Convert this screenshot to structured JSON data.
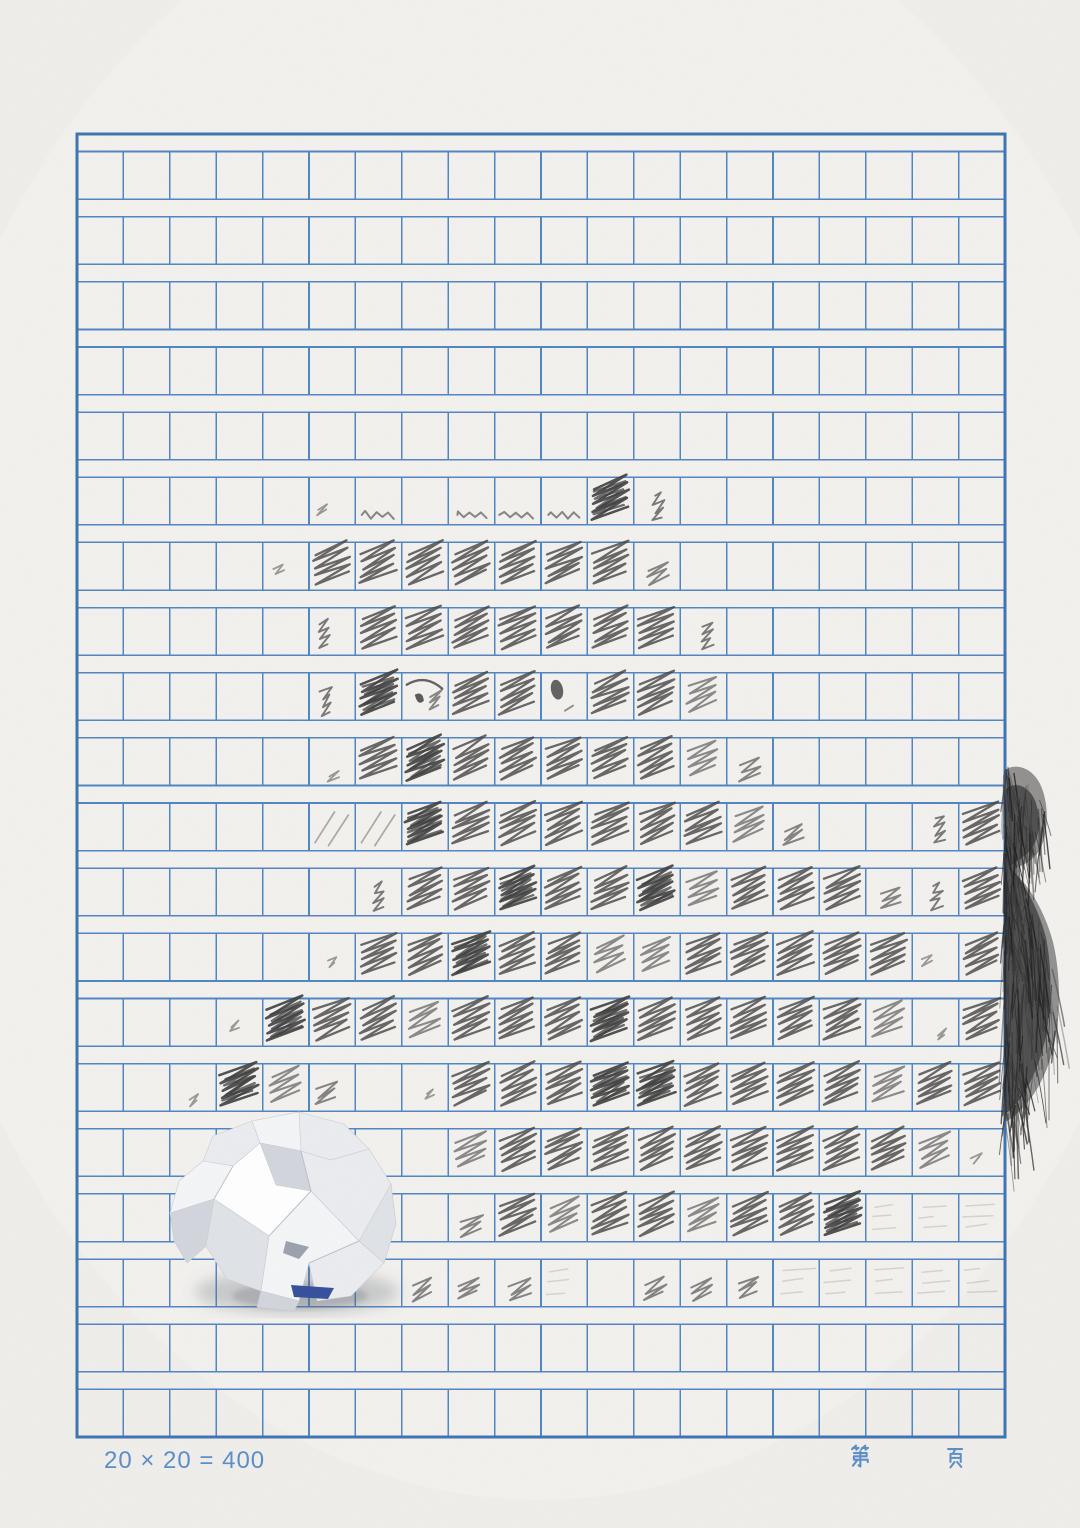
{
  "page": {
    "kind": "chinese-composition-manuscript-paper",
    "content_note": "blank squared writing grid, most cells scribbled out in pencil, crumpled paper ball on sheet, tuft of hair at right edge"
  },
  "grid": {
    "rows": 20,
    "cols": 20,
    "total_cells": 400
  },
  "footer": {
    "formula": "20 × 20 = 400",
    "page_prefix": "第",
    "page_suffix": "页"
  },
  "colors": {
    "paper": "#f1f0ed",
    "paper_edge": "#eceae6",
    "grid_line": "#4f85c2",
    "grid_border": "#3e73af",
    "pencil": "#3d3d3d",
    "pencil_faint": "#6a6a6a",
    "hair": "#242424",
    "footer_text": "#5d8ec7",
    "ball": [
      "#ffffff",
      "#f4f5f7",
      "#eaecef",
      "#dfe2e7",
      "#d2d6dc",
      "#c2c6ce"
    ],
    "ball_blue": "#34509b",
    "ball_crevice": "#9aa1ad",
    "ball_shadow": "rgba(104,108,122,0.30)"
  },
  "objects": {
    "paper_ball": {
      "type": "crumpled-paper-ball"
    },
    "hair_tuft": {
      "type": "pencil-drawn-hair-tuft"
    }
  },
  "scribbles": {
    "marks": [
      [
        6,
        6,
        "tiny"
      ],
      [
        6,
        7,
        "wave"
      ],
      [
        6,
        9,
        "wave"
      ],
      [
        6,
        10,
        "wave"
      ],
      [
        6,
        11,
        "wave"
      ],
      [
        6,
        12,
        "heavy"
      ],
      [
        6,
        13,
        "vsmall"
      ],
      [
        7,
        5,
        "tiny"
      ],
      [
        7,
        6,
        "full"
      ],
      [
        7,
        7,
        "full"
      ],
      [
        7,
        8,
        "full"
      ],
      [
        7,
        9,
        "full"
      ],
      [
        7,
        10,
        "full"
      ],
      [
        7,
        11,
        "full"
      ],
      [
        7,
        12,
        "full"
      ],
      [
        7,
        13,
        "small"
      ],
      [
        8,
        6,
        "vsmall"
      ],
      [
        8,
        7,
        "full"
      ],
      [
        8,
        8,
        "full"
      ],
      [
        8,
        9,
        "full"
      ],
      [
        8,
        10,
        "full"
      ],
      [
        8,
        11,
        "full"
      ],
      [
        8,
        12,
        "full"
      ],
      [
        8,
        13,
        "full"
      ],
      [
        8,
        14,
        "vsmall"
      ],
      [
        9,
        6,
        "vsmall"
      ],
      [
        9,
        7,
        "heavy"
      ],
      [
        9,
        8,
        "eyeL"
      ],
      [
        9,
        9,
        "full"
      ],
      [
        9,
        10,
        "full"
      ],
      [
        9,
        11,
        "eyeR"
      ],
      [
        9,
        12,
        "full"
      ],
      [
        9,
        13,
        "full"
      ],
      [
        9,
        14,
        "medium"
      ],
      [
        10,
        6,
        "tiny"
      ],
      [
        10,
        7,
        "full"
      ],
      [
        10,
        8,
        "heavy"
      ],
      [
        10,
        9,
        "full"
      ],
      [
        10,
        10,
        "full"
      ],
      [
        10,
        11,
        "full"
      ],
      [
        10,
        12,
        "full"
      ],
      [
        10,
        13,
        "full"
      ],
      [
        10,
        14,
        "medium"
      ],
      [
        10,
        15,
        "small"
      ],
      [
        11,
        6,
        "lines"
      ],
      [
        11,
        7,
        "lines"
      ],
      [
        11,
        8,
        "heavy"
      ],
      [
        11,
        9,
        "full"
      ],
      [
        11,
        10,
        "full"
      ],
      [
        11,
        11,
        "full"
      ],
      [
        11,
        12,
        "full"
      ],
      [
        11,
        13,
        "full"
      ],
      [
        11,
        14,
        "full"
      ],
      [
        11,
        15,
        "medium"
      ],
      [
        11,
        16,
        "small"
      ],
      [
        11,
        19,
        "vsmall"
      ],
      [
        11,
        20,
        "full"
      ],
      [
        12,
        7,
        "vsmall"
      ],
      [
        12,
        8,
        "full"
      ],
      [
        12,
        9,
        "full"
      ],
      [
        12,
        10,
        "heavy"
      ],
      [
        12,
        11,
        "full"
      ],
      [
        12,
        12,
        "full"
      ],
      [
        12,
        13,
        "heavy"
      ],
      [
        12,
        14,
        "medium"
      ],
      [
        12,
        15,
        "full"
      ],
      [
        12,
        16,
        "full"
      ],
      [
        12,
        17,
        "full"
      ],
      [
        12,
        18,
        "small"
      ],
      [
        12,
        19,
        "vsmall"
      ],
      [
        12,
        20,
        "full"
      ],
      [
        13,
        6,
        "tiny"
      ],
      [
        13,
        7,
        "full"
      ],
      [
        13,
        8,
        "full"
      ],
      [
        13,
        9,
        "heavy"
      ],
      [
        13,
        10,
        "full"
      ],
      [
        13,
        11,
        "full"
      ],
      [
        13,
        12,
        "medium"
      ],
      [
        13,
        13,
        "medium"
      ],
      [
        13,
        14,
        "full"
      ],
      [
        13,
        15,
        "full"
      ],
      [
        13,
        16,
        "full"
      ],
      [
        13,
        17,
        "full"
      ],
      [
        13,
        18,
        "full"
      ],
      [
        13,
        19,
        "tiny"
      ],
      [
        13,
        20,
        "full"
      ],
      [
        14,
        4,
        "tiny"
      ],
      [
        14,
        5,
        "heavy"
      ],
      [
        14,
        6,
        "full"
      ],
      [
        14,
        7,
        "full"
      ],
      [
        14,
        8,
        "medium"
      ],
      [
        14,
        9,
        "full"
      ],
      [
        14,
        10,
        "full"
      ],
      [
        14,
        11,
        "full"
      ],
      [
        14,
        12,
        "heavy"
      ],
      [
        14,
        13,
        "full"
      ],
      [
        14,
        14,
        "full"
      ],
      [
        14,
        15,
        "full"
      ],
      [
        14,
        16,
        "full"
      ],
      [
        14,
        17,
        "full"
      ],
      [
        14,
        18,
        "medium"
      ],
      [
        14,
        19,
        "tiny"
      ],
      [
        14,
        20,
        "full"
      ],
      [
        15,
        3,
        "tiny"
      ],
      [
        15,
        4,
        "heavy"
      ],
      [
        15,
        5,
        "medium"
      ],
      [
        15,
        6,
        "small"
      ],
      [
        15,
        8,
        "tiny"
      ],
      [
        15,
        9,
        "full"
      ],
      [
        15,
        10,
        "full"
      ],
      [
        15,
        11,
        "full"
      ],
      [
        15,
        12,
        "heavy"
      ],
      [
        15,
        13,
        "heavy"
      ],
      [
        15,
        14,
        "full"
      ],
      [
        15,
        15,
        "full"
      ],
      [
        15,
        16,
        "full"
      ],
      [
        15,
        17,
        "full"
      ],
      [
        15,
        18,
        "medium"
      ],
      [
        15,
        19,
        "full"
      ],
      [
        15,
        20,
        "full"
      ],
      [
        16,
        9,
        "medium"
      ],
      [
        16,
        10,
        "full"
      ],
      [
        16,
        11,
        "full"
      ],
      [
        16,
        12,
        "full"
      ],
      [
        16,
        13,
        "full"
      ],
      [
        16,
        14,
        "full"
      ],
      [
        16,
        15,
        "full"
      ],
      [
        16,
        16,
        "full"
      ],
      [
        16,
        17,
        "full"
      ],
      [
        16,
        18,
        "full"
      ],
      [
        16,
        19,
        "medium"
      ],
      [
        16,
        20,
        "tiny"
      ],
      [
        17,
        9,
        "small"
      ],
      [
        17,
        10,
        "full"
      ],
      [
        17,
        11,
        "medium"
      ],
      [
        17,
        12,
        "full"
      ],
      [
        17,
        13,
        "full"
      ],
      [
        17,
        14,
        "medium"
      ],
      [
        17,
        15,
        "full"
      ],
      [
        17,
        16,
        "full"
      ],
      [
        17,
        17,
        "heavy"
      ],
      [
        17,
        18,
        "faint"
      ],
      [
        17,
        19,
        "faint"
      ],
      [
        17,
        20,
        "faint"
      ],
      [
        18,
        8,
        "small"
      ],
      [
        18,
        9,
        "small"
      ],
      [
        18,
        10,
        "small"
      ],
      [
        18,
        11,
        "faint"
      ],
      [
        18,
        13,
        "small"
      ],
      [
        18,
        14,
        "small"
      ],
      [
        18,
        15,
        "small"
      ],
      [
        18,
        16,
        "faint"
      ],
      [
        18,
        17,
        "faint"
      ],
      [
        18,
        18,
        "faint"
      ],
      [
        18,
        19,
        "faint"
      ],
      [
        18,
        20,
        "faint"
      ]
    ]
  }
}
